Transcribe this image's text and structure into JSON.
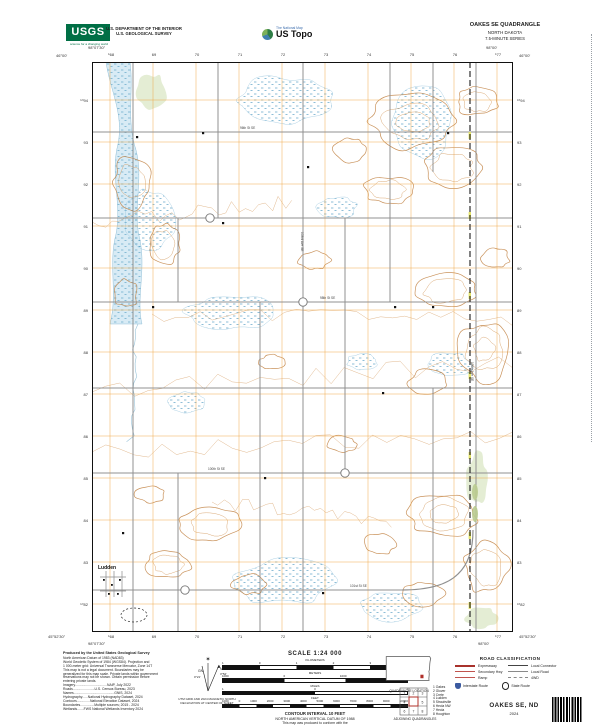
{
  "header": {
    "usgs_logo_text": "USGS",
    "usgs_tagline": "science for a changing world",
    "agency_line1": "U.S. DEPARTMENT OF THE INTERIOR",
    "agency_line2": "U.S. GEOLOGICAL SURVEY",
    "ustopo_super": "The National Map",
    "ustopo_brand": "US Topo",
    "quad_name": "OAKES SE QUADRANGLE",
    "quad_state": "NORTH DAKOTA",
    "quad_series": "7.5-MINUTE SERIES"
  },
  "map": {
    "corners": {
      "nw_lon": "98°07'30\"",
      "nw_lat": "46°00'",
      "ne_lon": "98°00'",
      "ne_lat": "46°00'",
      "sw_lon": "98°07'30\"",
      "sw_lat": "45°52'30\"",
      "se_lon": "98°00'",
      "se_lat": "45°52'30\""
    },
    "top_grid_labels": [
      "⁵68",
      "69",
      "70",
      "71",
      "72",
      "73",
      "74",
      "75",
      "76",
      "⁵77"
    ],
    "left_grid_labels": [
      "⁵⁰94",
      "93",
      "92",
      "91",
      "90",
      "89",
      "88",
      "87",
      "86",
      "85",
      "84",
      "83",
      "⁵⁰82"
    ],
    "place_labels": [
      {
        "text": "Ludden",
        "x": 6,
        "y": 507
      }
    ],
    "road_labels": [
      {
        "text": "96th St SE",
        "x": 148,
        "y": 67,
        "rot": 0
      },
      {
        "text": "98th St SE",
        "x": 228,
        "y": 237,
        "rot": 0
      },
      {
        "text": "100th St SE",
        "x": 116,
        "y": 408,
        "rot": 0
      },
      {
        "text": "101st St SE",
        "x": 258,
        "y": 525,
        "rot": 0
      },
      {
        "text": "103rd Ave SE",
        "x": 209,
        "y": 170,
        "rot": 90
      },
      {
        "text": "106th Ave SE",
        "x": 379,
        "y": 300,
        "rot": 90
      }
    ]
  },
  "footer": {
    "produced_by": "Produced by the United States Geological Survey",
    "credit_lines": [
      "North American Datum of 1983 (NAD83)",
      "World Geodetic System of 1984 (WGS84). Projection and",
      "1 000-meter grid: Universal Transverse Mercator, Zone 14T",
      "This map is not a legal document. Boundaries may be",
      "generalized for this map scale. Private lands within government",
      "reservations may not be shown. Obtain permission before",
      "entering private lands.",
      "Imagery..................................NAIP, July 2022",
      "Roads.......................U.S. Census Bureau, 2023",
      "Names...........................................GNIS, 2024",
      "Hydrography......National Hydrography Dataset, 2024",
      "Contours..............National Elevation Dataset, 2024",
      "Boundaries...............Multiple sources; 2015 - 2024",
      "Wetlands.......FWS National Wetlands Inventory 2024"
    ],
    "declination": {
      "star": "✶",
      "gn": "GN",
      "mn": "MN",
      "gn_value": "0°21'",
      "mn_value": "3°52'",
      "caption1": "UTM GRID AND 2024 MAGNETIC NORTH",
      "caption2": "DECLINATION AT CENTER OF SHEET"
    },
    "scale_title": "SCALE 1:24 000",
    "scale_bars": [
      {
        "unit": "KILOMETERS",
        "ticks": [
          "1",
          "0",
          "1",
          "2",
          "3",
          "4"
        ]
      },
      {
        "unit": "METERS",
        "ticks": [
          "1000",
          "0",
          "1000",
          "2000"
        ]
      },
      {
        "unit": "MILES",
        "ticks": [
          "1",
          "0",
          "1"
        ]
      },
      {
        "unit": "FEET",
        "ticks": [
          "1000",
          "0",
          "1000",
          "2000",
          "3000",
          "4000",
          "5000",
          "6000",
          "7000",
          "8000",
          "9000",
          "10000"
        ]
      }
    ],
    "contour_interval": "CONTOUR INTERVAL 10 FEET",
    "datum_note": "NORTH AMERICAN VERTICAL DATUM OF 1988",
    "standard_note1": "This map was produced to conform with the",
    "standard_note2": "National Geospatial Program US Topo Product Standard, 2011.",
    "quadrangle_location_label": "QUADRANGLE LOCATION",
    "adjoining_label": "ADJOINING QUADRANGLES",
    "adjoining_grid_numbers": [
      "1",
      "2",
      "3",
      "4",
      "5",
      "6",
      "7",
      "8"
    ],
    "adjoining_quads": [
      "1  Oakes",
      "2  Glover",
      "3  Crete",
      "4  Ludden",
      "5  Straubville",
      "6  Hecla NW",
      "7  Hecla",
      "8  Houghton"
    ],
    "road_classification": {
      "title": "ROAD CLASSIFICATION",
      "rows": [
        {
          "l_label": "Expressway",
          "l_style": "sw-expressway",
          "r_label": "Local Connector",
          "r_style": "sw-localconn"
        },
        {
          "l_label": "Secondary Hwy",
          "l_style": "sw-secondary",
          "r_label": "Local Road",
          "r_style": "sw-localroad"
        },
        {
          "l_label": "Ramp",
          "l_style": "sw-ramp",
          "r_label": "4WD",
          "r_style": "sw-4wd"
        }
      ],
      "marker1": "Interstate Route",
      "marker2": "State Route"
    },
    "sheet_name": "OAKES SE, ND",
    "sheet_year": "2024"
  },
  "colors": {
    "usgs_green": "#006F45",
    "legend_red": "#A8322C",
    "contour_brown": "#d49a5e",
    "grid_orange": "#EFA33C",
    "water_blue": "#D6EAF4",
    "marsh_blue": "#57A0C4",
    "road_gray": "#909090"
  }
}
